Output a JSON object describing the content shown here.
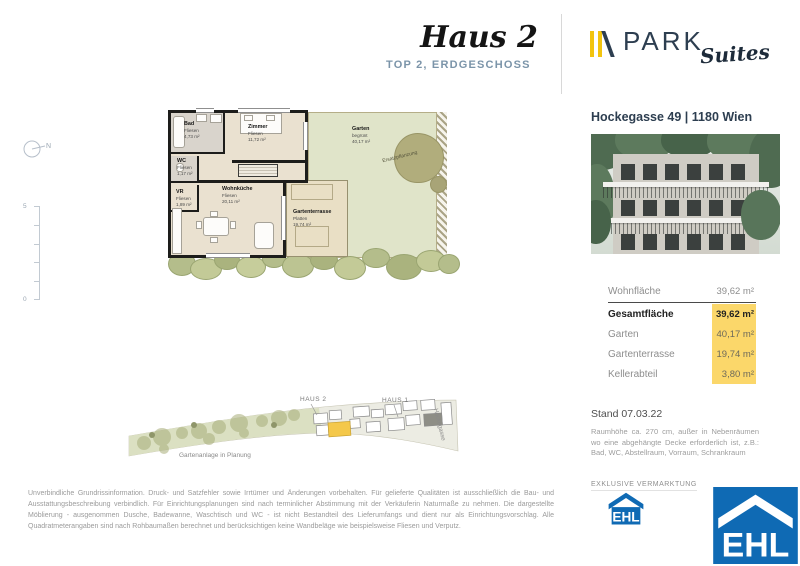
{
  "header": {
    "title": "Haus 2",
    "subtitle": "TOP 2, ERDGESCHOSS"
  },
  "brand": {
    "name": "PARK",
    "suffix": "Suites"
  },
  "plan": {
    "compass_label": "N",
    "scale_top": "5",
    "scale_bottom": "0",
    "rooms": [
      {
        "name": "Bad",
        "floor": "Fliesen",
        "area": "4,73 m²"
      },
      {
        "name": "Zimmer",
        "floor": "Fliesen",
        "area": "11,72 m²"
      },
      {
        "name": "WC",
        "floor": "Fliesen",
        "area": "1,17 m²"
      },
      {
        "name": "VR",
        "floor": "Fliesen",
        "area": "1,89 m²"
      },
      {
        "name": "Wohnküche",
        "floor": "Fliesen",
        "area": "20,11 m²"
      },
      {
        "name": "Gartenterrasse",
        "floor": "Platten",
        "area": "19,74 m²"
      },
      {
        "name": "Garten",
        "floor": "begrünt",
        "area": "40,17 m²"
      }
    ],
    "tree_label": "Ersatzpflanzung"
  },
  "siteplan": {
    "haus2": "HAUS 2",
    "haus1": "HAUS 1",
    "street": "Hockegasse",
    "caption": "Gartenanlage in Planung"
  },
  "sidebar": {
    "address": "Hockegasse 49 | 1180 Wien",
    "table": {
      "rows": [
        {
          "label": "Wohnfläche",
          "value": "39,62 m²"
        },
        {
          "label": "Gesamtfläche",
          "value": "39,62 m²"
        },
        {
          "label": "Garten",
          "value": "40,17 m²"
        },
        {
          "label": "Gartenterrasse",
          "value": "19,74 m²"
        },
        {
          "label": "Kellerabteil",
          "value": "3,80 m²"
        }
      ]
    },
    "stand": "Stand 07.03.22",
    "note": "Raumhöhe ca. 270 cm, außer in Nebenräumen wo eine abgehängte Decke erforderlich ist, z.B.: Bad, WC, Abstellraum, Vorraum, Schrankraum",
    "exclusive_label": "EXKLUSIVE VERMARKTUNG",
    "ehl_label": "EHL"
  },
  "footer": {
    "disclaimer": "Unverbindliche Grundrissinformation. Druck- und Satzfehler sowie Irrtümer und Änderungen vorbehalten. Für gelieferte Qualitäten ist ausschließlich die Bau- und Ausstattungsbeschreibung verbindlich. Für Einrichtungsplanungen sind nach terminlicher Abstimmung mit der Verkäuferin Naturmaße zu nehmen. Die dargestellte Möblierung - ausgenommen Dusche, Badewanne, Waschtisch und WC - ist nicht Bestandteil des Lieferumfangs und dient nur als Einrichtungsvorschlag. Alle Quadratmeterangaben sind nach Rohbaumaßen berechnet und berücksichtigen keine Wandbeläge wie beispielsweise Fliesen und Verputz."
  },
  "colors": {
    "accent_yellow": "#fbd76a",
    "brand_navy": "#2d3e50",
    "brand_yellow": "#f2c40f",
    "ehl_blue": "#0f6ab4",
    "subtitle_blue": "#7b94a9"
  }
}
